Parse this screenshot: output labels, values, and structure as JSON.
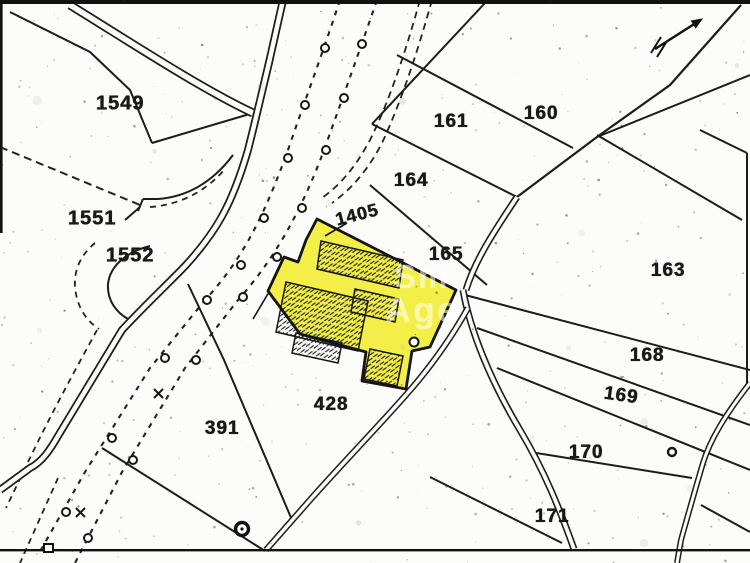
{
  "map": {
    "description": "cadastral-plan-with-highlighted-plot",
    "highlight_color": "#f2ee3e",
    "line_color": "#1c1c1c",
    "paper_color": "#fcfcfa",
    "watermark": {
      "line1": "Sm",
      "line2": "Age"
    },
    "highlighted_plot": "1405",
    "parcel_labels": [
      {
        "text": "1549",
        "x": 120,
        "y": 104,
        "rot": 0,
        "fs": 20
      },
      {
        "text": "1551",
        "x": 92,
        "y": 219,
        "rot": 0,
        "fs": 20
      },
      {
        "text": "1552",
        "x": 130,
        "y": 256,
        "rot": 0,
        "fs": 20
      },
      {
        "text": "1405",
        "x": 357,
        "y": 215,
        "rot": -14,
        "fs": 18
      },
      {
        "text": "161",
        "x": 451,
        "y": 122,
        "rot": 0,
        "fs": 19
      },
      {
        "text": "160",
        "x": 541,
        "y": 114,
        "rot": 0,
        "fs": 19
      },
      {
        "text": "164",
        "x": 411,
        "y": 181,
        "rot": 0,
        "fs": 19
      },
      {
        "text": "165",
        "x": 446,
        "y": 255,
        "rot": 0,
        "fs": 19
      },
      {
        "text": "163",
        "x": 668,
        "y": 271,
        "rot": 0,
        "fs": 19
      },
      {
        "text": "168",
        "x": 647,
        "y": 356,
        "rot": 0,
        "fs": 19
      },
      {
        "text": "169",
        "x": 621,
        "y": 396,
        "rot": 8,
        "fs": 19
      },
      {
        "text": "170",
        "x": 586,
        "y": 453,
        "rot": 0,
        "fs": 19
      },
      {
        "text": "171",
        "x": 552,
        "y": 517,
        "rot": 0,
        "fs": 19
      },
      {
        "text": "391",
        "x": 222,
        "y": 429,
        "rot": 0,
        "fs": 19
      },
      {
        "text": "428",
        "x": 331,
        "y": 405,
        "rot": 0,
        "fs": 19
      }
    ],
    "symbols": [
      "north-arrow",
      "well-symbol",
      "pole-markers",
      "cross-marks",
      "access-point-circle",
      "parcel-circle-marker"
    ]
  }
}
